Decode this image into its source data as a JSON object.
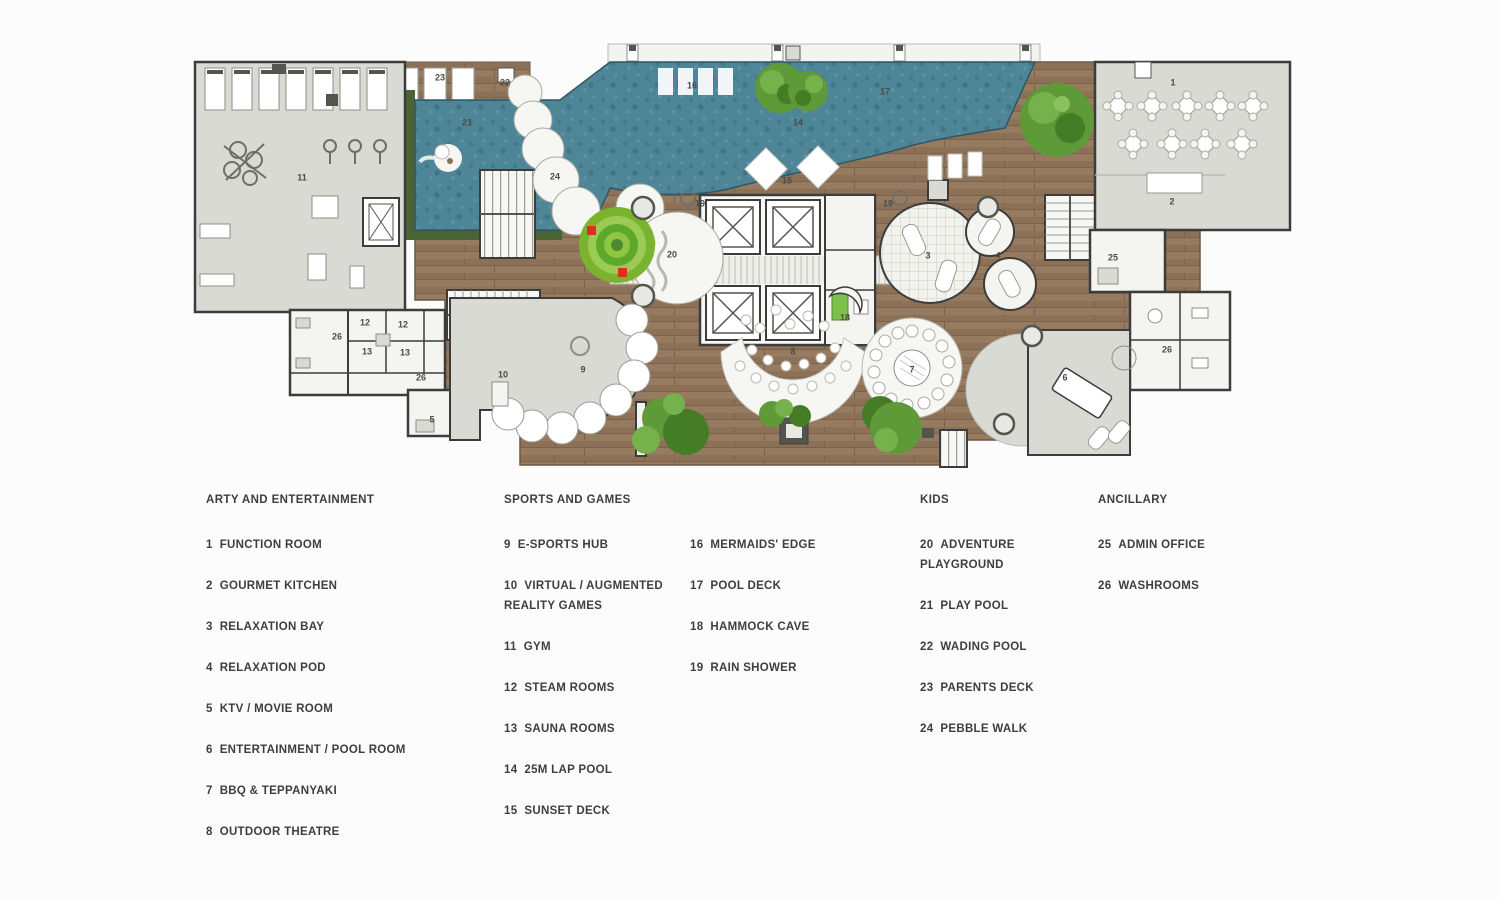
{
  "title": "Amenity floor plan",
  "colors": {
    "pool": "#4e8597",
    "pool_dark": "#3e7486",
    "deck": "#8d7157",
    "room_grey": "#dadad4",
    "room_white": "#f4f4f0",
    "wall": "#3c3c3c",
    "hedge": "#4b6334",
    "tree": "#5f9a39",
    "tree_dark": "#447d26",
    "playground_green": "#7ab32e",
    "accent_red": "#d8311f"
  },
  "plan": {
    "markers": [
      {
        "n": "1",
        "x": 993,
        "y": 55
      },
      {
        "n": "2",
        "x": 992,
        "y": 174
      },
      {
        "n": "3",
        "x": 748,
        "y": 228
      },
      {
        "n": "4",
        "x": 818,
        "y": 228
      },
      {
        "n": "5",
        "x": 252,
        "y": 392
      },
      {
        "n": "6",
        "x": 885,
        "y": 350
      },
      {
        "n": "7",
        "x": 732,
        "y": 342
      },
      {
        "n": "8",
        "x": 613,
        "y": 324
      },
      {
        "n": "9",
        "x": 403,
        "y": 342
      },
      {
        "n": "10",
        "x": 323,
        "y": 347
      },
      {
        "n": "11",
        "x": 122,
        "y": 150
      },
      {
        "n": "12",
        "x": 185,
        "y": 295
      },
      {
        "n": "12",
        "x": 223,
        "y": 297
      },
      {
        "n": "13",
        "x": 187,
        "y": 324
      },
      {
        "n": "13",
        "x": 225,
        "y": 325
      },
      {
        "n": "14",
        "x": 618,
        "y": 95
      },
      {
        "n": "15",
        "x": 607,
        "y": 153
      },
      {
        "n": "16",
        "x": 512,
        "y": 58
      },
      {
        "n": "17",
        "x": 705,
        "y": 64
      },
      {
        "n": "18",
        "x": 665,
        "y": 290
      },
      {
        "n": "19",
        "x": 520,
        "y": 176
      },
      {
        "n": "19",
        "x": 708,
        "y": 176
      },
      {
        "n": "20",
        "x": 492,
        "y": 227
      },
      {
        "n": "21",
        "x": 287,
        "y": 95
      },
      {
        "n": "22",
        "x": 325,
        "y": 55
      },
      {
        "n": "23",
        "x": 260,
        "y": 50
      },
      {
        "n": "24",
        "x": 375,
        "y": 149
      },
      {
        "n": "25",
        "x": 933,
        "y": 230
      },
      {
        "n": "26",
        "x": 157,
        "y": 309
      },
      {
        "n": "26",
        "x": 241,
        "y": 350
      },
      {
        "n": "26",
        "x": 987,
        "y": 322
      }
    ]
  },
  "legend": {
    "columns": [
      {
        "heading": "ARTY AND ENTERTAINMENT",
        "items": [
          {
            "num": "1",
            "label": "FUNCTION ROOM"
          },
          {
            "num": "2",
            "label": "GOURMET KITCHEN"
          },
          {
            "num": "3",
            "label": "RELAXATION BAY"
          },
          {
            "num": "4",
            "label": "RELAXATION POD"
          },
          {
            "num": "5",
            "label": "KTV / MOVIE ROOM"
          },
          {
            "num": "6",
            "label": "ENTERTAINMENT / POOL ROOM"
          },
          {
            "num": "7",
            "label": "BBQ & TEPPANYAKI"
          },
          {
            "num": "8",
            "label": "OUTDOOR THEATRE"
          }
        ]
      },
      {
        "heading": "SPORTS AND GAMES",
        "items": [
          {
            "num": "9",
            "label": "E-SPORTS HUB"
          },
          {
            "num": "10",
            "label": "VIRTUAL / AUGMENTED REALITY GAMES"
          },
          {
            "num": "11",
            "label": "GYM"
          },
          {
            "num": "12",
            "label": "STEAM ROOMS"
          },
          {
            "num": "13",
            "label": "SAUNA ROOMS"
          },
          {
            "num": "14",
            "label": "25M LAP POOL"
          },
          {
            "num": "15",
            "label": "SUNSET DECK"
          }
        ]
      },
      {
        "heading": null,
        "items": [
          {
            "num": "16",
            "label": "MERMAIDS' EDGE"
          },
          {
            "num": "17",
            "label": "POOL DECK"
          },
          {
            "num": "18",
            "label": "HAMMOCK CAVE"
          },
          {
            "num": "19",
            "label": "RAIN SHOWER"
          }
        ]
      },
      {
        "heading": "KIDS",
        "items": [
          {
            "num": "20",
            "label": "ADVENTURE PLAYGROUND"
          },
          {
            "num": "21",
            "label": "PLAY POOL"
          },
          {
            "num": "22",
            "label": "WADING POOL"
          },
          {
            "num": "23",
            "label": "PARENTS DECK"
          },
          {
            "num": "24",
            "label": "PEBBLE WALK"
          }
        ]
      },
      {
        "heading": "ANCILLARY",
        "items": [
          {
            "num": "25",
            "label": "ADMIN OFFICE"
          },
          {
            "num": "26",
            "label": "WASHROOMS"
          }
        ]
      }
    ]
  }
}
